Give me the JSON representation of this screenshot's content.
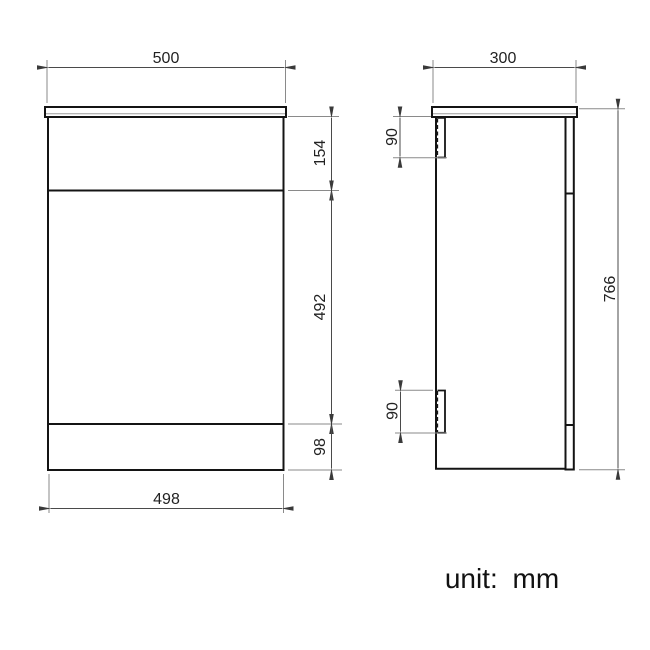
{
  "unit_note": "unit: mm",
  "dimensions": {
    "front": {
      "top_width": "500",
      "bottom_width": "498",
      "upper_section_height": "154",
      "door_section_height": "492",
      "plinth_section_height": "98"
    },
    "side": {
      "depth": "300",
      "overall_height": "766",
      "top_fixing_height": "90",
      "bottom_fixing_height": "90"
    }
  },
  "colors": {
    "background": "#ffffff",
    "object_line": "#141414",
    "dimension_line": "#4a4a4a",
    "extension_line": "#8a8a8a",
    "text": "#222222"
  }
}
